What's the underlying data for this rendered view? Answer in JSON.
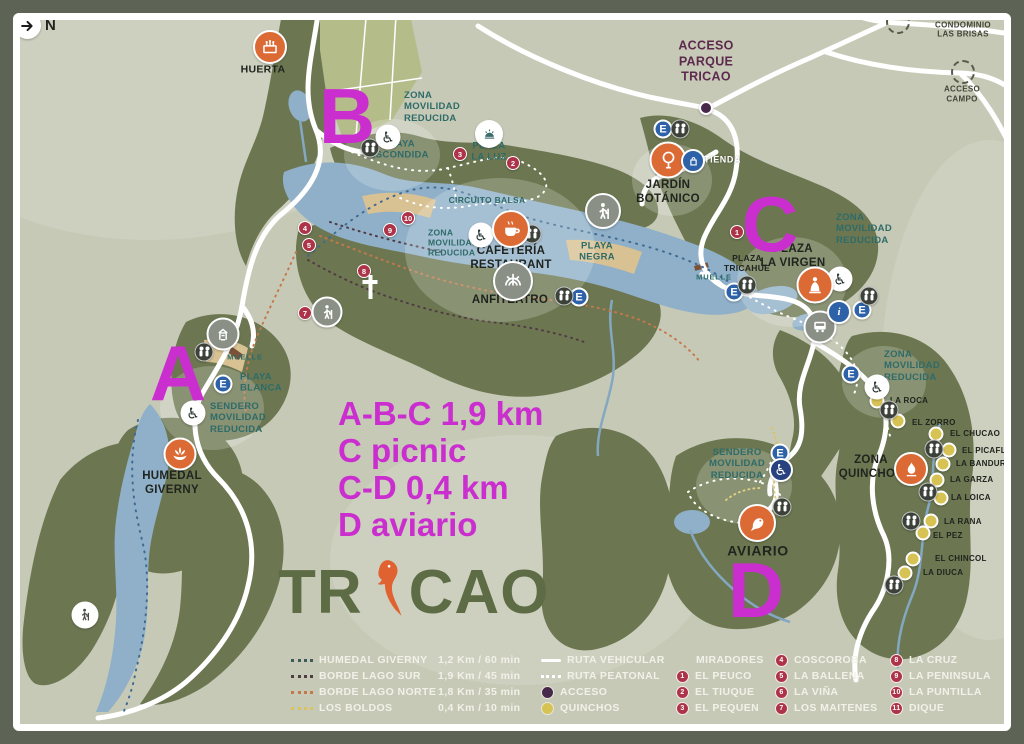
{
  "compass": {
    "label": "N"
  },
  "annotations": {
    "color": "#cb2ecf",
    "letters": [
      {
        "text": "A",
        "x": 178,
        "y": 373
      },
      {
        "text": "B",
        "x": 347,
        "y": 116
      },
      {
        "text": "C",
        "x": 770,
        "y": 224
      },
      {
        "text": "D",
        "x": 756,
        "y": 590
      }
    ],
    "notes": [
      {
        "text": "A-B-C 1,9 km"
      },
      {
        "text": "C picnic"
      },
      {
        "text": "C-D 0,4 km"
      },
      {
        "text": "D aviario"
      }
    ]
  },
  "logo": {
    "left": "TR",
    "right": "CAO",
    "color": "#5d6c45",
    "parrot_color": "#df6230"
  },
  "markers": {
    "parking_letter": "E",
    "info_letter": "i",
    "wheelchair_glyph": "♿"
  },
  "map_labels": [
    {
      "text": "HUERTA",
      "x": 263,
      "y": 70,
      "cls": "black sm"
    },
    {
      "text": "ZONA\nMOVILIDAD\nREDUCIDA",
      "x": 404,
      "y": 107,
      "cls": "teal l"
    },
    {
      "text": "PLAYA\nESCONDIDA",
      "x": 399,
      "y": 150,
      "cls": "teal"
    },
    {
      "text": "PLAZA\nLA LUZ",
      "x": 489,
      "y": 152,
      "cls": "teal"
    },
    {
      "text": "ACCESO\nPARQUE\nTRICAO",
      "x": 706,
      "y": 62,
      "cls": "maroon"
    },
    {
      "text": "ACCESO CONDOMINIO\nLAS BRISAS",
      "x": 963,
      "y": 25,
      "cls": "darks"
    },
    {
      "text": "ACCESO\nCAMPO",
      "x": 962,
      "y": 94,
      "cls": "darks"
    },
    {
      "text": "JARDÍN\nBOTÁNICO",
      "x": 668,
      "y": 193,
      "cls": "black"
    },
    {
      "text": "TIENDA",
      "x": 704,
      "y": 160,
      "cls": "whites l"
    },
    {
      "text": "CIRCUITO BALSA",
      "x": 487,
      "y": 200,
      "cls": "teal sm"
    },
    {
      "text": "ZONA\nMOVILIDAD\nREDUCIDA",
      "x": 428,
      "y": 243,
      "cls": "teal sm l"
    },
    {
      "text": "CAFETERÍA\nRESTAURANT",
      "x": 511,
      "y": 259,
      "cls": "black"
    },
    {
      "text": "PLAYA\nNEGRA",
      "x": 597,
      "y": 252,
      "cls": "teal"
    },
    {
      "text": "ANFITEATRO",
      "x": 510,
      "y": 301,
      "cls": "black"
    },
    {
      "text": "ZONA\nMOVILIDAD\nREDUCIDA",
      "x": 836,
      "y": 229,
      "cls": "teal l"
    },
    {
      "text": "PLAZA\nLA VIRGEN",
      "x": 793,
      "y": 257,
      "cls": "black"
    },
    {
      "text": "PLAZA\nTRICAHUE",
      "x": 747,
      "y": 263,
      "cls": "blacks"
    },
    {
      "text": "MUELLE",
      "x": 714,
      "y": 277,
      "cls": "tealt"
    },
    {
      "text": "MUELLE",
      "x": 245,
      "y": 357,
      "cls": "tealt"
    },
    {
      "text": "PLAYA\nBLANCA",
      "x": 240,
      "y": 383,
      "cls": "teal l"
    },
    {
      "text": "SENDERO\nMOVILIDAD\nREDUCIDA",
      "x": 210,
      "y": 418,
      "cls": "teal l"
    },
    {
      "text": "HUMEDAL\nGIVERNY",
      "x": 172,
      "y": 484,
      "cls": "black"
    },
    {
      "text": "ZONA\nMOVILIDAD\nREDUCIDA",
      "x": 884,
      "y": 366,
      "cls": "teal l"
    },
    {
      "text": "LA ROCA",
      "x": 890,
      "y": 401,
      "cls": "blackt l"
    },
    {
      "text": "EL ZORRO",
      "x": 912,
      "y": 423,
      "cls": "blackt l"
    },
    {
      "text": "EL CHUCAO",
      "x": 950,
      "y": 434,
      "cls": "blackt l"
    },
    {
      "text": "EL PICAFLOR",
      "x": 962,
      "y": 451,
      "cls": "blackt l"
    },
    {
      "text": "LA BANDURRIA",
      "x": 956,
      "y": 464,
      "cls": "blackt l"
    },
    {
      "text": "LA GARZA",
      "x": 950,
      "y": 480,
      "cls": "blackt l"
    },
    {
      "text": "LA LOICA",
      "x": 951,
      "y": 498,
      "cls": "blackt l"
    },
    {
      "text": "LA RANA",
      "x": 944,
      "y": 522,
      "cls": "blackt l"
    },
    {
      "text": "EL PEZ",
      "x": 933,
      "y": 536,
      "cls": "blackt l"
    },
    {
      "text": "EL CHINCOL",
      "x": 935,
      "y": 559,
      "cls": "blackt l"
    },
    {
      "text": "LA DIUCA",
      "x": 923,
      "y": 573,
      "cls": "blackt l"
    },
    {
      "text": "ZONA\nQUINCHOS",
      "x": 871,
      "y": 468,
      "cls": "black"
    },
    {
      "text": "SENDERO\nMOVILIDAD\nREDUCIDA",
      "x": 737,
      "y": 464,
      "cls": "teal"
    },
    {
      "text": "AVIARIO",
      "x": 758,
      "y": 551,
      "cls": "black md"
    }
  ],
  "mirador_dots": [
    {
      "n": "1",
      "x": 737,
      "y": 232
    },
    {
      "n": "2",
      "x": 513,
      "y": 163
    },
    {
      "n": "3",
      "x": 460,
      "y": 154
    },
    {
      "n": "4",
      "x": 305,
      "y": 228
    },
    {
      "n": "5",
      "x": 309,
      "y": 245
    },
    {
      "n": "7",
      "x": 305,
      "y": 313
    },
    {
      "n": "8",
      "x": 364,
      "y": 271
    },
    {
      "n": "9",
      "x": 390,
      "y": 230
    },
    {
      "n": "10",
      "x": 408,
      "y": 218
    }
  ],
  "quincho_dots": [
    {
      "x": 877,
      "y": 401
    },
    {
      "x": 898,
      "y": 421
    },
    {
      "x": 936,
      "y": 434
    },
    {
      "x": 949,
      "y": 450
    },
    {
      "x": 943,
      "y": 464
    },
    {
      "x": 937,
      "y": 480
    },
    {
      "x": 941,
      "y": 498
    },
    {
      "x": 931,
      "y": 521
    },
    {
      "x": 923,
      "y": 533
    },
    {
      "x": 913,
      "y": 559
    },
    {
      "x": 905,
      "y": 573
    }
  ],
  "parking_dots": [
    {
      "x": 663,
      "y": 129
    },
    {
      "x": 579,
      "y": 297
    },
    {
      "x": 734,
      "y": 292
    },
    {
      "x": 862,
      "y": 310
    },
    {
      "x": 851,
      "y": 374
    },
    {
      "x": 223,
      "y": 384
    },
    {
      "x": 780,
      "y": 453
    }
  ],
  "restroom_dots": [
    {
      "x": 370,
      "y": 148
    },
    {
      "x": 680,
      "y": 129
    },
    {
      "x": 532,
      "y": 234
    },
    {
      "x": 564,
      "y": 296
    },
    {
      "x": 747,
      "y": 285
    },
    {
      "x": 869,
      "y": 296
    },
    {
      "x": 204,
      "y": 352
    },
    {
      "x": 889,
      "y": 410
    },
    {
      "x": 934,
      "y": 449
    },
    {
      "x": 928,
      "y": 492
    },
    {
      "x": 911,
      "y": 521
    },
    {
      "x": 894,
      "y": 585
    },
    {
      "x": 782,
      "y": 507
    }
  ],
  "wheelchair_dots": [
    {
      "x": 388,
      "y": 137
    },
    {
      "x": 481,
      "y": 235
    },
    {
      "x": 840,
      "y": 279
    },
    {
      "x": 877,
      "y": 387
    },
    {
      "x": 193,
      "y": 413
    },
    {
      "x": 781,
      "y": 470,
      "cls": "bluebg"
    }
  ],
  "legend": {
    "trails": [
      {
        "name": "HUMEDAL GIVERNY",
        "value": "1,2 Km / 60 min",
        "color": "#3c5a57"
      },
      {
        "name": "BORDE LAGO SUR",
        "value": "1,9 Km / 45 min",
        "color": "#503b42"
      },
      {
        "name": "BORDE LAGO NORTE",
        "value": "1,8 Km / 35 min",
        "color": "#c5784b"
      },
      {
        "name": "LOS BOLDOS",
        "value": "0,4 Km / 10 min",
        "color": "#d9c45f"
      }
    ],
    "routes": [
      {
        "label": "RUTA VEHICULAR"
      },
      {
        "label": "RUTA PEATONAL"
      },
      {
        "label": "ACCESO"
      },
      {
        "label": "QUINCHOS"
      }
    ],
    "miradores_title": "MIRADORES",
    "miradores_col1": [
      {
        "num": "1",
        "label": "EL PEUCO"
      },
      {
        "num": "2",
        "label": "EL TIUQUE"
      },
      {
        "num": "3",
        "label": "EL PEQUEN"
      }
    ],
    "miradores_col2": [
      {
        "num": "4",
        "label": "COSCOROBA"
      },
      {
        "num": "5",
        "label": "LA BALLENA"
      },
      {
        "num": "6",
        "label": "LA VIÑA"
      },
      {
        "num": "7",
        "label": "LOS MAITENES"
      }
    ],
    "miradores_col3": [
      {
        "num": "8",
        "label": "LA CRUZ"
      },
      {
        "num": "9",
        "label": "LA PENINSULA"
      },
      {
        "num": "10",
        "label": "LA PUNTILLA"
      },
      {
        "num": "11",
        "label": "DIQUE"
      }
    ]
  },
  "colors": {
    "background": "#c6c9b6",
    "border": "#5e6455",
    "forest": "#6c7751",
    "lake": "#8fb0c8",
    "annotation_magenta": "#cb2ecf",
    "logo_green": "#5d6c45",
    "logo_orange": "#df6230",
    "teal_label": "#2e6b69",
    "maroon_label": "#5d2a4e",
    "mirador_red": "#ad3448",
    "quincho_yellow": "#d7c254",
    "acceso_purple": "#46284a",
    "parking_blue": "#2e62a8",
    "marker_orange": "#dc6a35",
    "beach": "#d8c193"
  }
}
